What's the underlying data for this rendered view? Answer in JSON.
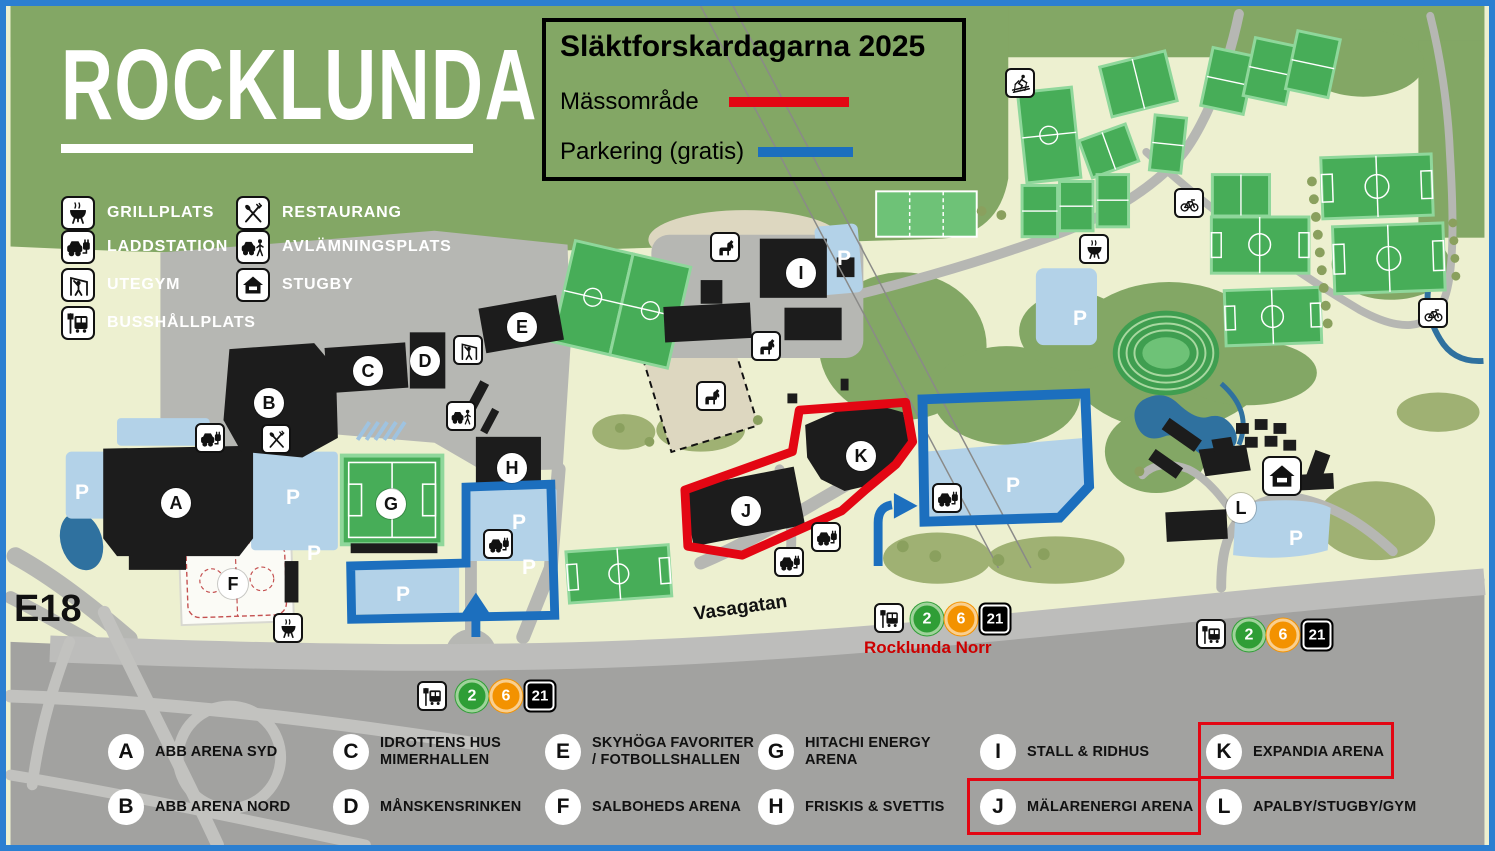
{
  "header": {
    "logo": "ROCKLUNDA"
  },
  "event_legend": {
    "title": "Släktforskardagarna 2025",
    "items": [
      {
        "label": "Mässområde",
        "color": "#e30613"
      },
      {
        "label": "Parkering (gratis)",
        "color": "#1c6fbe"
      }
    ]
  },
  "amenity_legend": {
    "items": [
      {
        "icon": "grill-icon",
        "label": "GRILLPLATS"
      },
      {
        "icon": "charging-station-icon",
        "label": "LADDSTATION"
      },
      {
        "icon": "outdoor-gym-icon",
        "label": "UTEGYM"
      },
      {
        "icon": "bus-stop-icon",
        "label": "BUSSHÅLLPLATS"
      },
      {
        "icon": "restaurant-icon",
        "label": "RESTAURANG"
      },
      {
        "icon": "drop-off-icon",
        "label": "AVLÄMNINGSPLATS"
      },
      {
        "icon": "cabin-icon",
        "label": "STUGBY"
      }
    ]
  },
  "map": {
    "parking_label": "P",
    "road_labels": {
      "vasagatan": "Vasagatan",
      "e18": "E18"
    },
    "bus_stop_name": "Rocklunda Norr",
    "markers": [
      {
        "letter": "A"
      },
      {
        "letter": "B"
      },
      {
        "letter": "C"
      },
      {
        "letter": "D"
      },
      {
        "letter": "E"
      },
      {
        "letter": "F"
      },
      {
        "letter": "G"
      },
      {
        "letter": "H"
      },
      {
        "letter": "I"
      },
      {
        "letter": "J"
      },
      {
        "letter": "K"
      },
      {
        "letter": "L"
      }
    ],
    "map_icons": [
      "charging-station-icon",
      "grill-icon",
      "outdoor-gym-icon",
      "drop-off-icon",
      "horse-riding-icon",
      "skier-icon",
      "bicycle-icon",
      "bus-stop-icon",
      "cabin-icon"
    ]
  },
  "transit": {
    "lines": [
      {
        "number": "2",
        "color": "#2f9e36"
      },
      {
        "number": "6",
        "color": "#f39200"
      },
      {
        "number": "21",
        "color": "#000000"
      }
    ]
  },
  "building_index": [
    {
      "letter": "A",
      "name": "ABB ARENA SYD",
      "highlighted": false
    },
    {
      "letter": "B",
      "name": "ABB ARENA NORD",
      "highlighted": false
    },
    {
      "letter": "C",
      "name": "IDROTTENS HUS\nMIMERHALLEN",
      "highlighted": false
    },
    {
      "letter": "D",
      "name": "MÅNSKENSRINKEN",
      "highlighted": false
    },
    {
      "letter": "E",
      "name": "SKYHÖGA FAVORITER\n/ FOTBOLLSHALLEN",
      "highlighted": false
    },
    {
      "letter": "F",
      "name": "SALBOHEDS ARENA",
      "highlighted": false
    },
    {
      "letter": "G",
      "name": "HITACHI ENERGY\nARENA",
      "highlighted": false
    },
    {
      "letter": "H",
      "name": "FRISKIS & SVETTIS",
      "highlighted": false
    },
    {
      "letter": "I",
      "name": "STALL & RIDHUS",
      "highlighted": false
    },
    {
      "letter": "J",
      "name": "MÄLARENERGI ARENA",
      "highlighted": true
    },
    {
      "letter": "K",
      "name": "EXPANDIA ARENA",
      "highlighted": true
    },
    {
      "letter": "L",
      "name": "APALBY/STUGBY/GYM",
      "highlighted": false
    }
  ],
  "colors": {
    "frame_border": "#2b7fd1",
    "massomrade_outline": "#e30613",
    "parkering_outline": "#1c6fbe",
    "stop_name_text": "#cc0000"
  }
}
